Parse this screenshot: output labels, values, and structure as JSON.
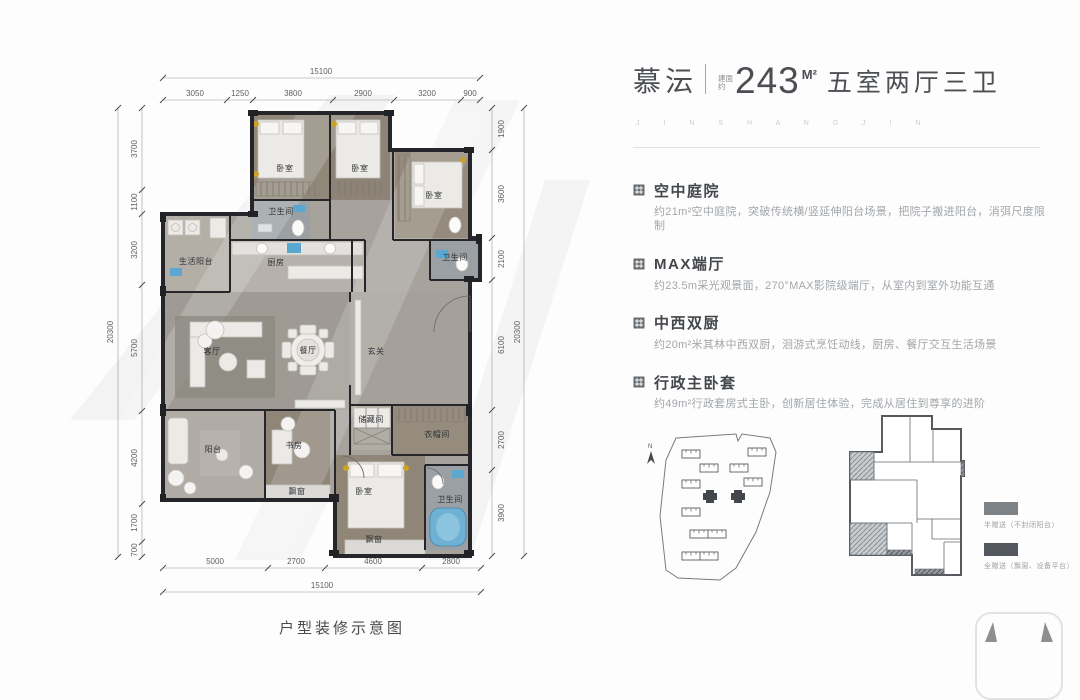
{
  "header": {
    "project_name": "慕沄",
    "area_prefix": "建面约",
    "area_value": "243",
    "area_unit": "M²",
    "layout_text": "五室两厅三卫",
    "watermark": "J I N S H A N G J I N"
  },
  "features": [
    {
      "title": "空中庭院",
      "desc": "约21m²空中庭院，突破传统横/竖延伸阳台场景，把院子搬进阳台，消弭尺度限制"
    },
    {
      "title": "MAX端厅",
      "desc": "约23.5m采光观景面，270°MAX影院级端厅，从室内到室外功能互通"
    },
    {
      "title": "中西双厨",
      "desc": "约20m²米其林中西双厨，洄游式烹饪动线，厨房、餐厅交互生活场景"
    },
    {
      "title": "行政主卧套",
      "desc": "约49m²行政套房式主卧，创新居住体验，完成从居住到尊享的进阶"
    }
  ],
  "floorplan": {
    "caption": "户型装修示意图",
    "rooms": [
      "卧室",
      "卧室",
      "卧室",
      "卫生间",
      "生活阳台",
      "厨房",
      "卫生间",
      "客厅",
      "餐厅",
      "玄关",
      "储藏间",
      "衣帽间",
      "阳台",
      "书房",
      "飘窗",
      "卧室",
      "飘窗",
      "卫生间"
    ],
    "dims": {
      "top_total": "15100",
      "top": [
        "3050",
        "1250",
        "3800",
        "2900",
        "3200",
        "900"
      ],
      "bottom": [
        "5000",
        "2700",
        "4600",
        "2800"
      ],
      "bottom_total": "15100",
      "left_total": "20300",
      "left": [
        "3700",
        "1100",
        "3200",
        "5700",
        "4200",
        "1700",
        "700"
      ],
      "right": [
        "1900",
        "3600",
        "2100",
        "6100",
        "2700",
        "3900"
      ],
      "right_total": "20300"
    }
  },
  "siteplan": {
    "north_label": "N"
  },
  "keyplan": {
    "legend": [
      {
        "label": "半赠送（不封闭阳台）",
        "color": "#7d8287"
      },
      {
        "label": "全赠送（飘窗、设备平台）",
        "color": "#54585e"
      }
    ]
  },
  "colors": {
    "wall": "#26262a",
    "accent_blue": "#5aa7cf",
    "gold": "#c9a227",
    "wood_floor": "#8f8678",
    "tile_floor": "#a7a39c"
  }
}
